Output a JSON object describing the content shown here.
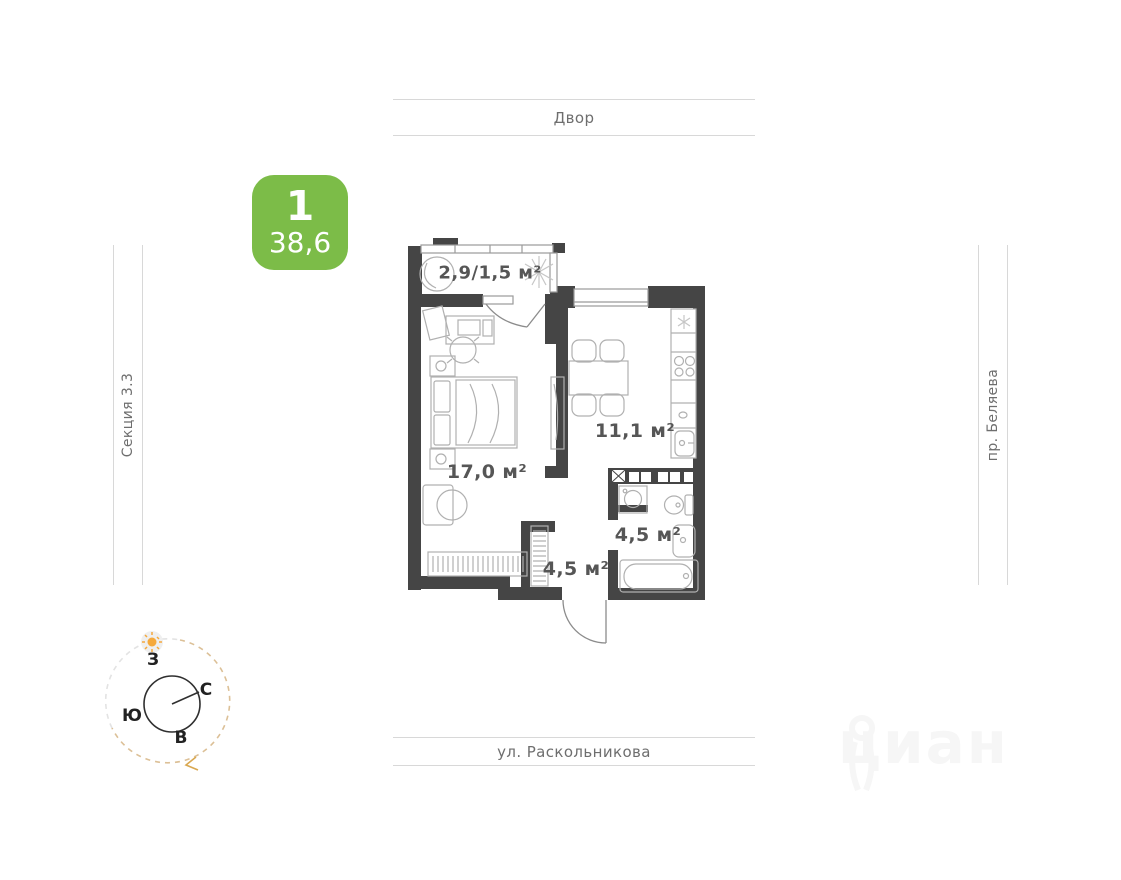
{
  "badge": {
    "rooms_count": "1",
    "total_area": "38,6",
    "color": "#7cbc48"
  },
  "surroundings": {
    "top": "Двор",
    "bottom": "ул. Раскольникова",
    "left": "Секция 3.3",
    "right": "пр. Беляева"
  },
  "plan": {
    "rooms": [
      {
        "name": "balcony",
        "area_label": "2,9/1,5 м²"
      },
      {
        "name": "living-room",
        "area_label": "17,0 м²"
      },
      {
        "name": "kitchen",
        "area_label": "11,1 м²"
      },
      {
        "name": "bathroom",
        "area_label": "4,5 м²"
      },
      {
        "name": "hallway",
        "area_label": "4,5 м²"
      }
    ]
  },
  "compass": {
    "west": "З",
    "north": "С",
    "south": "Ю",
    "east": "В"
  },
  "watermark": {
    "text": "циан"
  },
  "icons": {
    "ac_snowflake": "❄",
    "compass_sun": "☀",
    "kitchen_vent": "✳"
  },
  "colors": {
    "walls": "#454545",
    "furniture_lines": "#b0b0b0",
    "street_lines": "#d8d8d8",
    "compass_dash_tan": "#dcc097",
    "sun": "#f5a93c"
  }
}
